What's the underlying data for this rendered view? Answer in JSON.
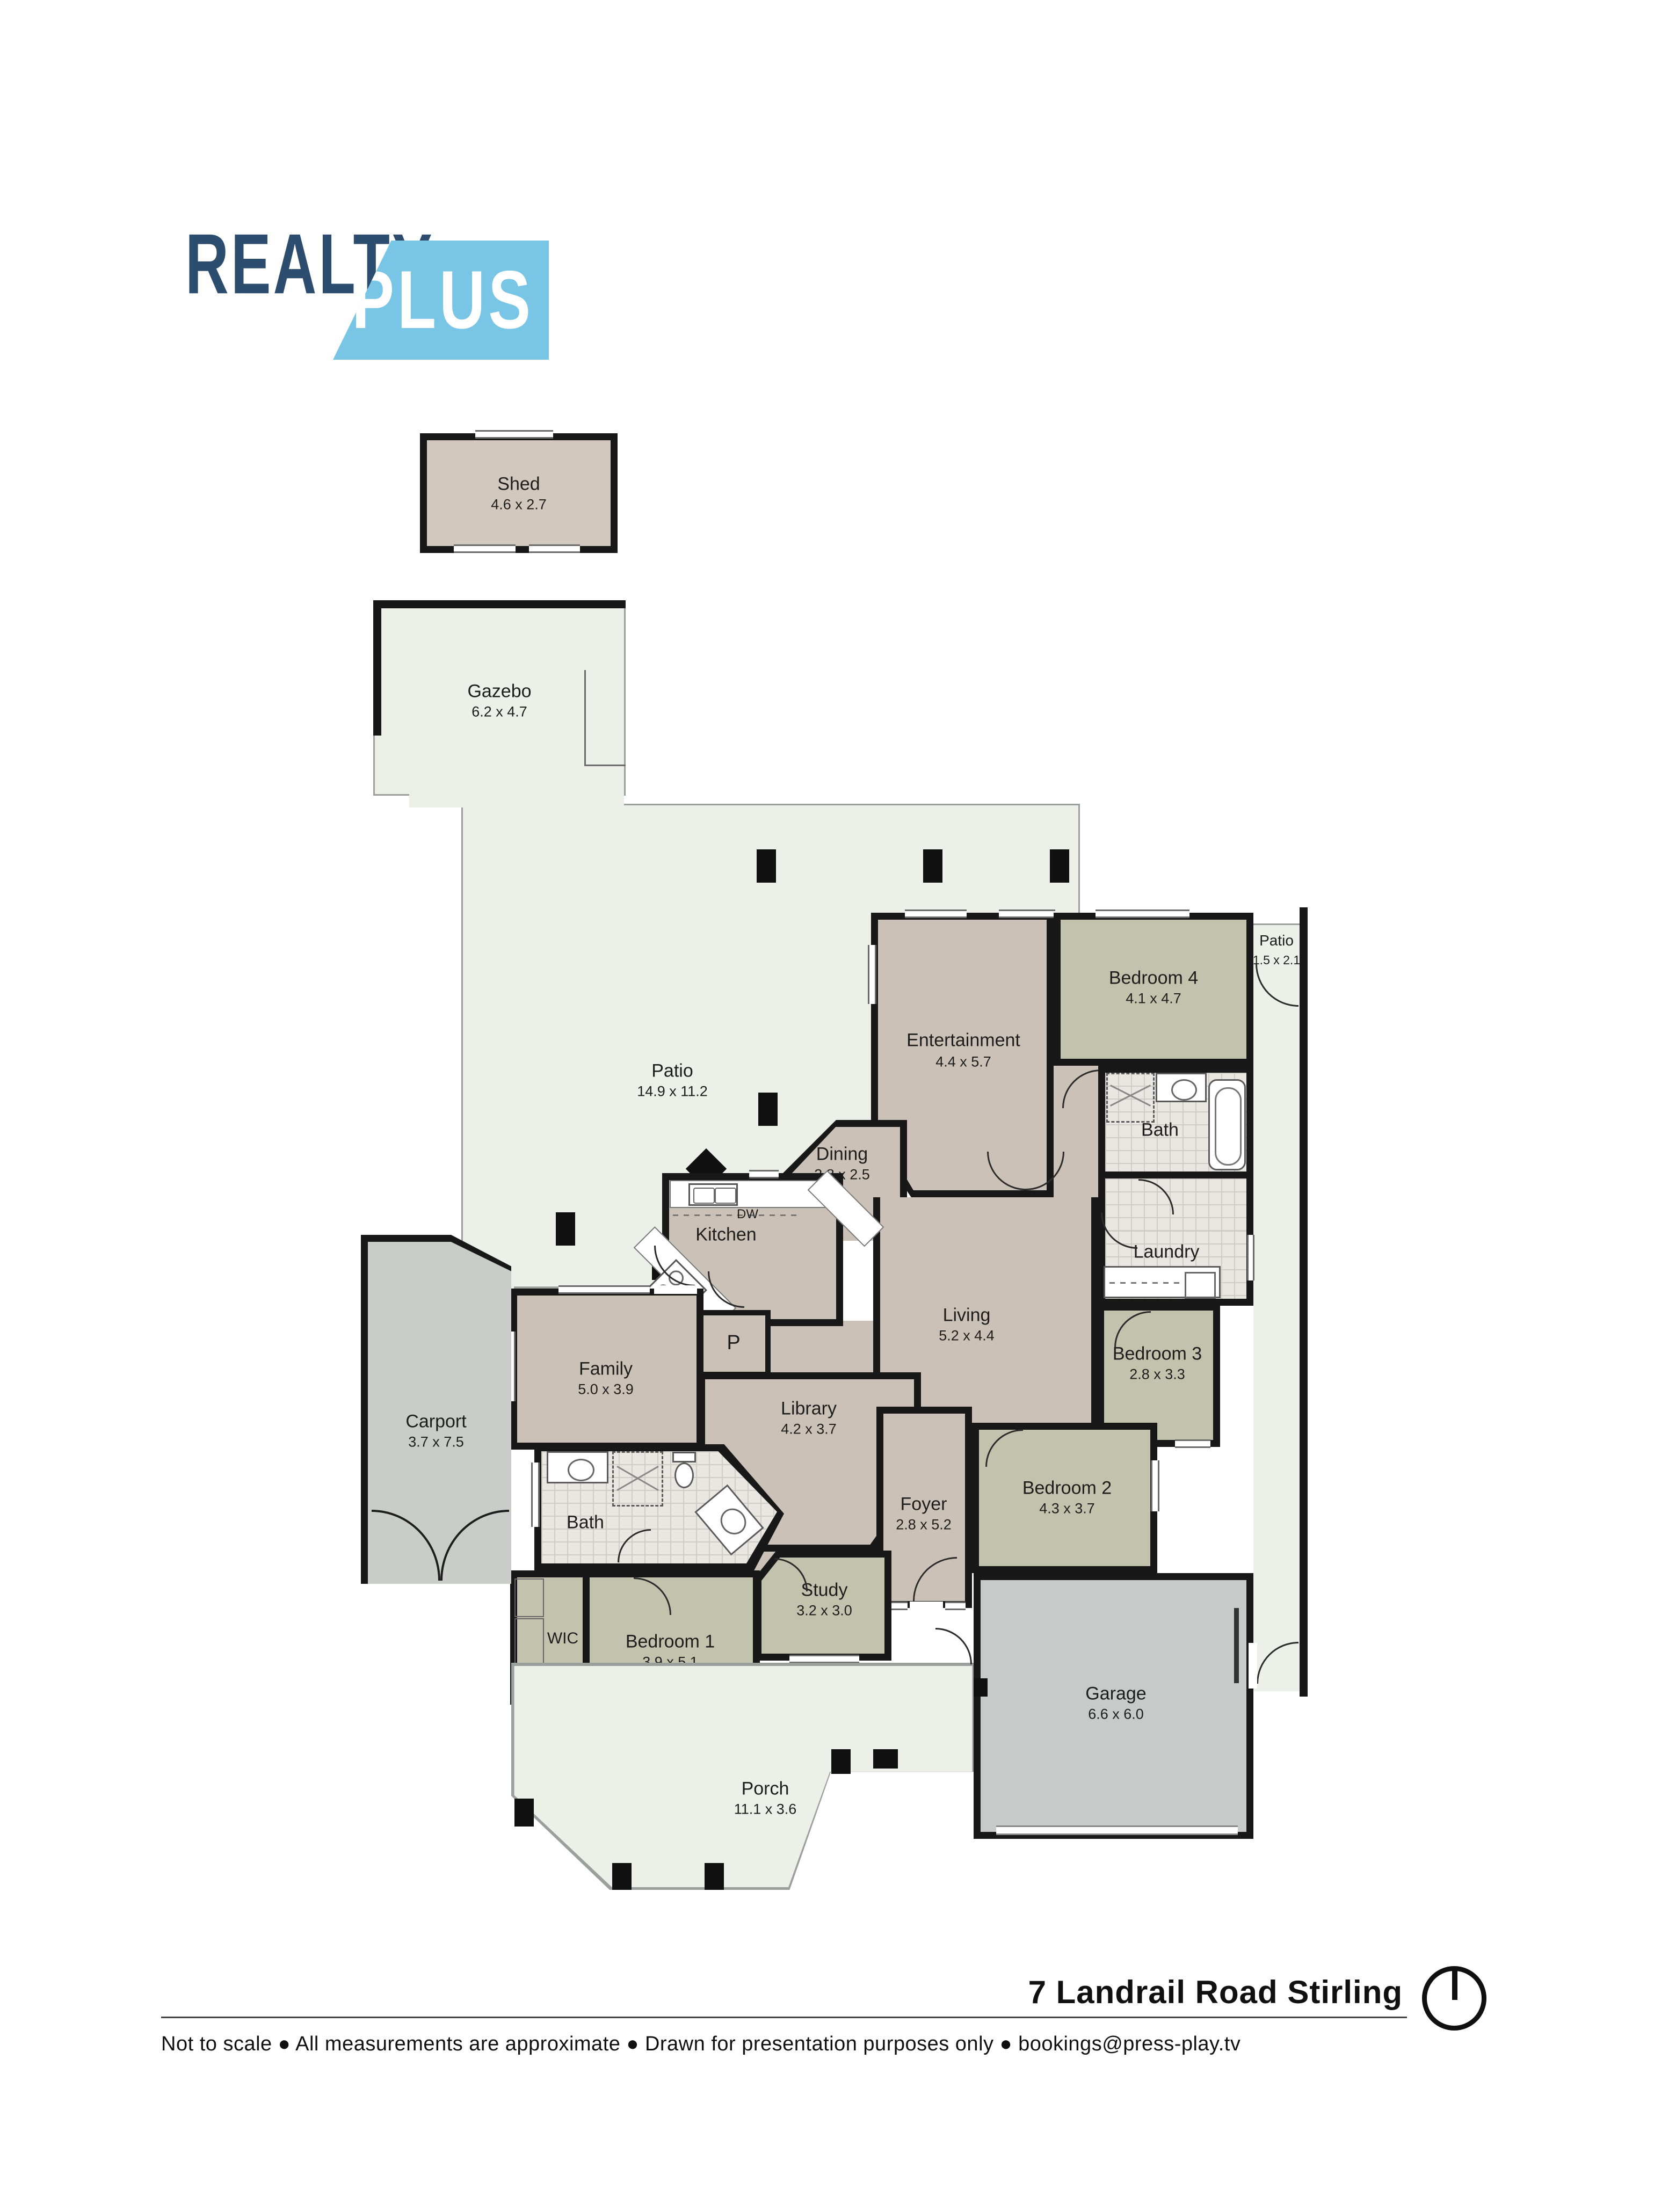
{
  "logo": {
    "realty": "REALTY",
    "plus": "PLUS"
  },
  "rooms": {
    "shed": {
      "name": "Shed",
      "dims": "4.6 x 2.7"
    },
    "gazebo": {
      "name": "Gazebo",
      "dims": "6.2 x 4.7"
    },
    "patio_main": {
      "name": "Patio",
      "dims": "14.9 x 11.2"
    },
    "patio_side": {
      "name": "Patio",
      "dims": "1.5 x 2.1"
    },
    "entertainment": {
      "name": "Entertainment",
      "dims": "4.4 x 5.7"
    },
    "bedroom4": {
      "name": "Bedroom 4",
      "dims": "4.1 x 4.7"
    },
    "bath_ensuite": {
      "name": "Bath"
    },
    "laundry": {
      "name": "Laundry"
    },
    "bedroom3": {
      "name": "Bedroom 3",
      "dims": "2.8 x 3.3"
    },
    "dining": {
      "name": "Dining",
      "dims": "3.8 x 2.5"
    },
    "living": {
      "name": "Living",
      "dims": "5.2 x 4.4"
    },
    "kitchen": {
      "name": "Kitchen",
      "dw": "DW",
      "pantry": "P"
    },
    "family": {
      "name": "Family",
      "dims": "5.0 x 3.9"
    },
    "library": {
      "name": "Library",
      "dims": "4.2 x 3.7"
    },
    "foyer": {
      "name": "Foyer",
      "dims": "2.8 x 5.2"
    },
    "bedroom2": {
      "name": "Bedroom 2",
      "dims": "4.3 x 3.7"
    },
    "bath_main": {
      "name": "Bath"
    },
    "wic": {
      "name": "WIC"
    },
    "bedroom1": {
      "name": "Bedroom 1",
      "dims": "3.9 x 5.1"
    },
    "study": {
      "name": "Study",
      "dims": "3.2 x 3.0"
    },
    "garage": {
      "name": "Garage",
      "dims": "6.6 x 6.0"
    },
    "carport": {
      "name": "Carport",
      "dims": "3.7 x 7.5"
    },
    "porch": {
      "name": "Porch",
      "dims": "11.1 x 3.6"
    }
  },
  "footer": {
    "title": "7 Landrail Road Stirling",
    "disclaimer": "Not to scale ● All measurements are approximate ● Drawn for presentation purposes only ● bookings@press-play.tv"
  },
  "colors": {
    "tan": "#ccc1b7",
    "sage": "#c1c3ad",
    "patio": "#edefe9",
    "carport_gray": "#c9cdc9",
    "garage_gray": "#c6cac8",
    "wall": "#181818",
    "logo_navy": "#2c4d6e",
    "logo_blue": "#79c5e6"
  }
}
